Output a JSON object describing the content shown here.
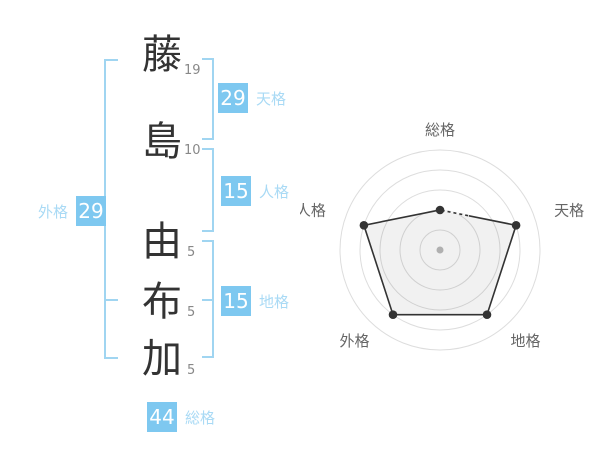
{
  "characters": [
    {
      "char": "藤",
      "strokes": "19"
    },
    {
      "char": "島",
      "strokes": "10"
    },
    {
      "char": "由",
      "strokes": "5"
    },
    {
      "char": "布",
      "strokes": "5"
    },
    {
      "char": "加",
      "strokes": "5"
    }
  ],
  "scores": {
    "tenkaku": {
      "label": "天格",
      "value": "29"
    },
    "jinkaku": {
      "label": "人格",
      "value": "15"
    },
    "chikaku": {
      "label": "地格",
      "value": "15"
    },
    "gaikaku": {
      "label": "外格",
      "value": "29"
    },
    "soukaku": {
      "label": "総格",
      "value": "44"
    }
  },
  "colors": {
    "accent": "#7ec8f0",
    "accent_light": "#a9daf5",
    "bracket": "#a0d5f1",
    "ink": "#333333",
    "muted": "#888888",
    "chart_grid": "#dddddd",
    "chart_line": "#333333",
    "chart_label": "#666666",
    "chart_center_dot": "#bbbbbb"
  },
  "chart_data": {
    "type": "radar",
    "categories": [
      "総格",
      "天格",
      "地格",
      "外格",
      "人格"
    ],
    "values": [
      40,
      80,
      80,
      80,
      80
    ],
    "max": 100,
    "rings": 5,
    "start_angle_deg": -90,
    "direction": "clockwise",
    "grid": "circular",
    "fill": "rgba(0,0,0,0.055)",
    "legend": "none",
    "title": ""
  }
}
